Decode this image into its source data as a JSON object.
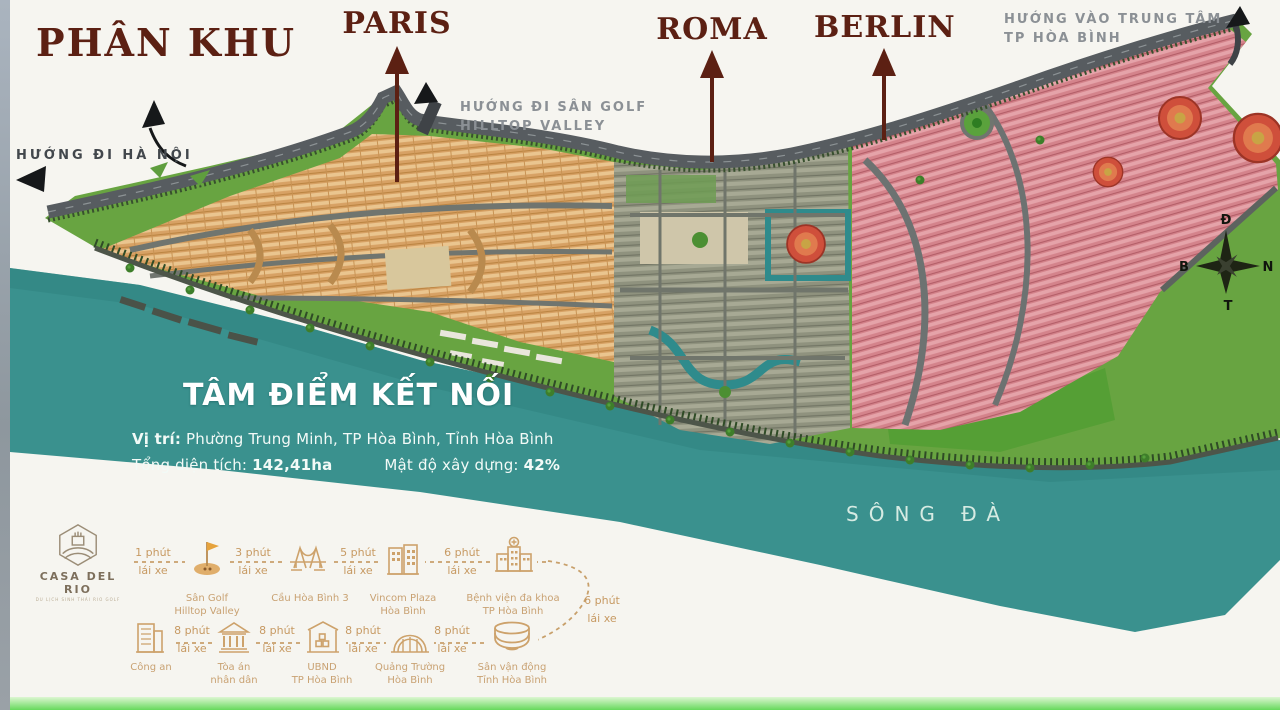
{
  "title": "PHÂN KHU",
  "zones": {
    "paris": "PARIS",
    "roma": "ROMA",
    "berlin": "BERLIN"
  },
  "directions": {
    "hanoi": "HƯỚNG ĐI HÀ NỘI",
    "golf_line1": "HƯỚNG ĐI SÂN GOLF",
    "golf_line2": "HILLTOP VALLEY",
    "center_line1": "HƯỚNG VÀO TRUNG TÂM",
    "center_line2": "TP HÒA BÌNH"
  },
  "info": {
    "headline": "TÂM ĐIỂM KẾT NỐI",
    "location_label": "Vị trí:",
    "location_value": " Phường Trung Minh, TP Hòa Bình, Tỉnh Hòa Bình",
    "area_label": "Tổng diện tích: ",
    "area_value": "142,41ha",
    "density_label": "Mật độ xây dựng: ",
    "density_value": "42%"
  },
  "river_name": "SÔNG ĐÀ",
  "compass": {
    "top": "Đ",
    "left": "B",
    "right": "N",
    "bottom": "T"
  },
  "brand": {
    "name": "CASA DEL RIO",
    "tagline": "DU LỊCH SINH THÁI RIO GOLF"
  },
  "legend": {
    "row1": [
      {
        "icon": "golf-flag",
        "time": "1 phút",
        "mode": "lái xe",
        "name_line1": "Sân Golf",
        "name_line2": "Hilltop Valley"
      },
      {
        "icon": "bridge",
        "time": "3 phút",
        "mode": "lái xe",
        "name_line1": "Cầu Hòa Bình 3",
        "name_line2": ""
      },
      {
        "icon": "mall",
        "time": "5 phút",
        "mode": "lái xe",
        "name_line1": "Vincom Plaza",
        "name_line2": "Hòa Bình"
      },
      {
        "icon": "hospital",
        "time": "6 phút",
        "mode": "lái xe",
        "name_line1": "Bệnh viện đa khoa",
        "name_line2": "TP Hòa Bình"
      }
    ],
    "connector": {
      "time": "6 phút",
      "mode": "lái xe"
    },
    "row2": [
      {
        "icon": "police-office",
        "name_line1": "Công an",
        "name_line2": "",
        "time": "8 phút",
        "mode": "lái xe"
      },
      {
        "icon": "courthouse",
        "name_line1": "Tòa án",
        "name_line2": "nhân dân",
        "time": "8 phút",
        "mode": "lái xe"
      },
      {
        "icon": "city-hall",
        "name_line1": "UBND",
        "name_line2": "TP Hòa Bình",
        "time": "8 phút",
        "mode": "lái xe"
      },
      {
        "icon": "theater",
        "name_line1": "Quảng Trường",
        "name_line2": "Hòa Bình",
        "time": "8 phút",
        "mode": "lái xe"
      },
      {
        "icon": "stadium",
        "name_line1": "Sân vận động",
        "name_line2": "Tỉnh Hòa Bình"
      }
    ]
  },
  "palette": {
    "river": "#3a918e",
    "land_green": "#68a441",
    "paris_zone": "#d7a164",
    "roma_zone": "#8f927e",
    "berlin_zone": "#d4838b",
    "road": "#575c60",
    "title_maroon": "#5c2013",
    "legend_gold": "#c79a63"
  }
}
